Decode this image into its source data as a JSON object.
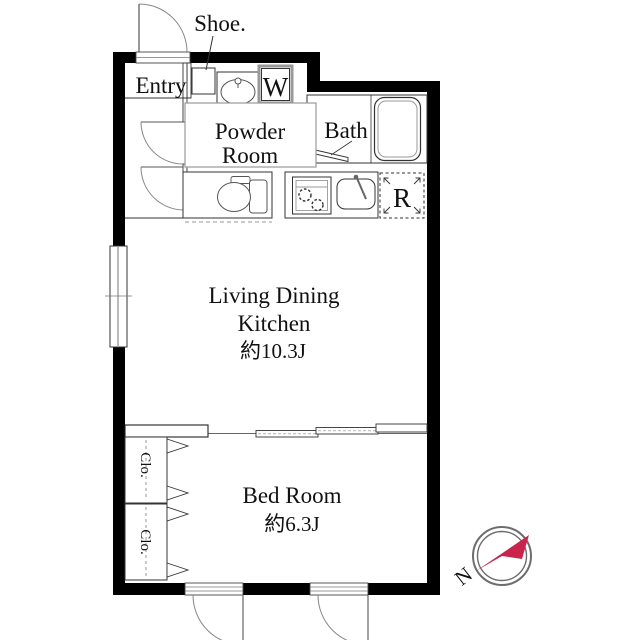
{
  "floorplan": {
    "labels": {
      "shoe": "Shoe.",
      "entry": "Entry",
      "washer": "W",
      "powder_line1": "Powder",
      "powder_line2": "Room",
      "bath": "Bath",
      "fridge": "R",
      "ldk_line1": "Living Dining",
      "ldk_line2": "Kitchen",
      "ldk_size": "約10.3J",
      "bedroom": "Bed Room",
      "bedroom_size": "約6.3J",
      "closet_top": "Clo.",
      "closet_bottom": "Clo.",
      "compass_north": "N"
    },
    "colors": {
      "wall": "#000000",
      "line": "#333333",
      "fixture": "#8a8a8a",
      "label_box_border": "#9a9a9a",
      "compass_ring": "#6d6d6d",
      "compass_red": "#c9244e"
    }
  }
}
